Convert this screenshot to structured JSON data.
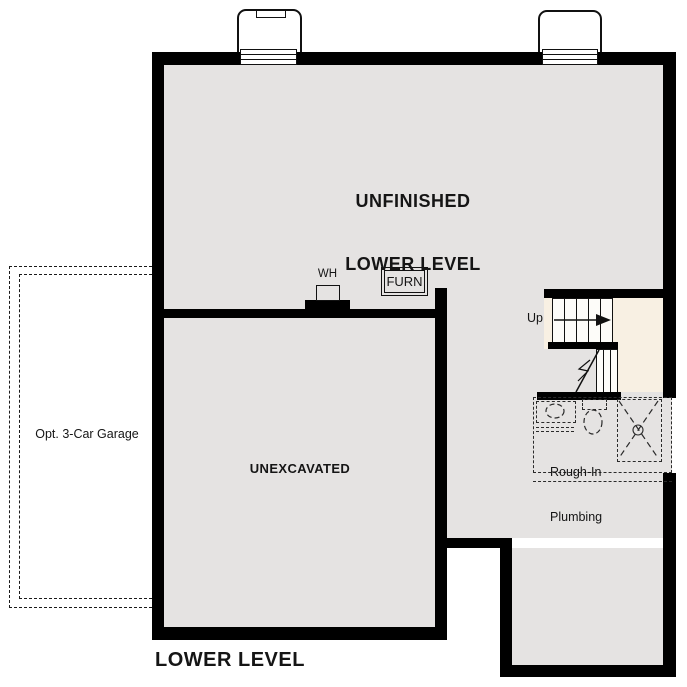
{
  "plan_title": "LOWER LEVEL",
  "rooms": {
    "unfinished_lower_level": {
      "line1": "UNFINISHED",
      "line2": "LOWER LEVEL"
    },
    "unexcavated": {
      "label": "UNEXCAVATED"
    },
    "opt_garage": {
      "label": "Opt. 3-Car Garage"
    },
    "rough_in_plumbing": {
      "line1": "Rough-In",
      "line2": "Plumbing"
    }
  },
  "stairs": {
    "up_label": "Up",
    "direction": "up"
  },
  "equipment": {
    "water_heater_label": "WH",
    "furnace_label": "FURN"
  },
  "features": [
    "window-well-left",
    "window-well-right",
    "basement-window-left",
    "basement-window-right",
    "stair-upper-flight",
    "stair-lower-flight",
    "rough-in-sink",
    "rough-in-toilet",
    "rough-in-shower"
  ],
  "colors": {
    "wall": "#000000",
    "floor": "#e5e3e2",
    "stair_area": "#f8f0e3",
    "background": "#ffffff",
    "dashed_outline": "#1a1a1a",
    "text": "#151515"
  }
}
